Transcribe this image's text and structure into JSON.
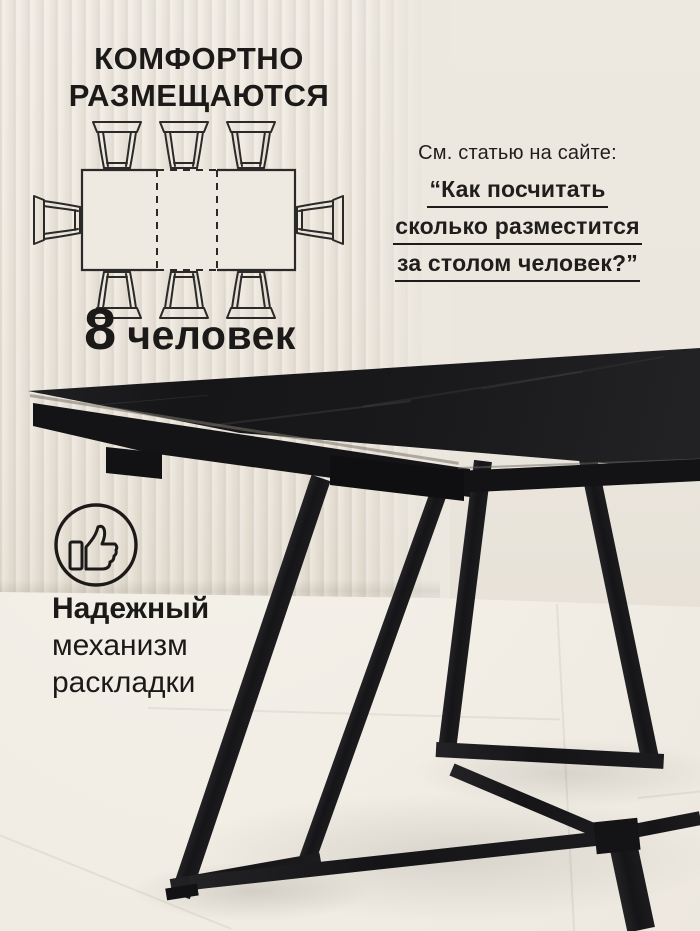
{
  "meta": {
    "language": "ru",
    "canvas_width": 700,
    "canvas_height": 931
  },
  "colors": {
    "text": "#1b1a18",
    "wall": "#ece7de",
    "floor": "#f2eee6",
    "table_top": "#19191b",
    "table_legs": "#1a1a1c",
    "underline": "#1d1c1a"
  },
  "headline": {
    "line1": "КОМФОРТНО",
    "line2": "РАЗМЕЩАЮТСЯ"
  },
  "seating_diagram": {
    "icon": "seating-plan-diagram",
    "table_shape": "rectangular-extendable-with-dashed-leaf",
    "chairs_top": 3,
    "chairs_bottom": 3,
    "chairs_left": 1,
    "chairs_right": 1,
    "total_chairs": 8
  },
  "capacity": {
    "number": "8",
    "unit": "человек"
  },
  "article_note": {
    "intro": "См. статью на сайте:",
    "title_line1": "“Как посчитать",
    "title_line2": "сколько разместится",
    "title_line3": "за столом человек?”"
  },
  "feature": {
    "icon": "thumbs-up-icon",
    "line1": "Надежный",
    "line2": "механизм",
    "line3": "раскладки"
  }
}
